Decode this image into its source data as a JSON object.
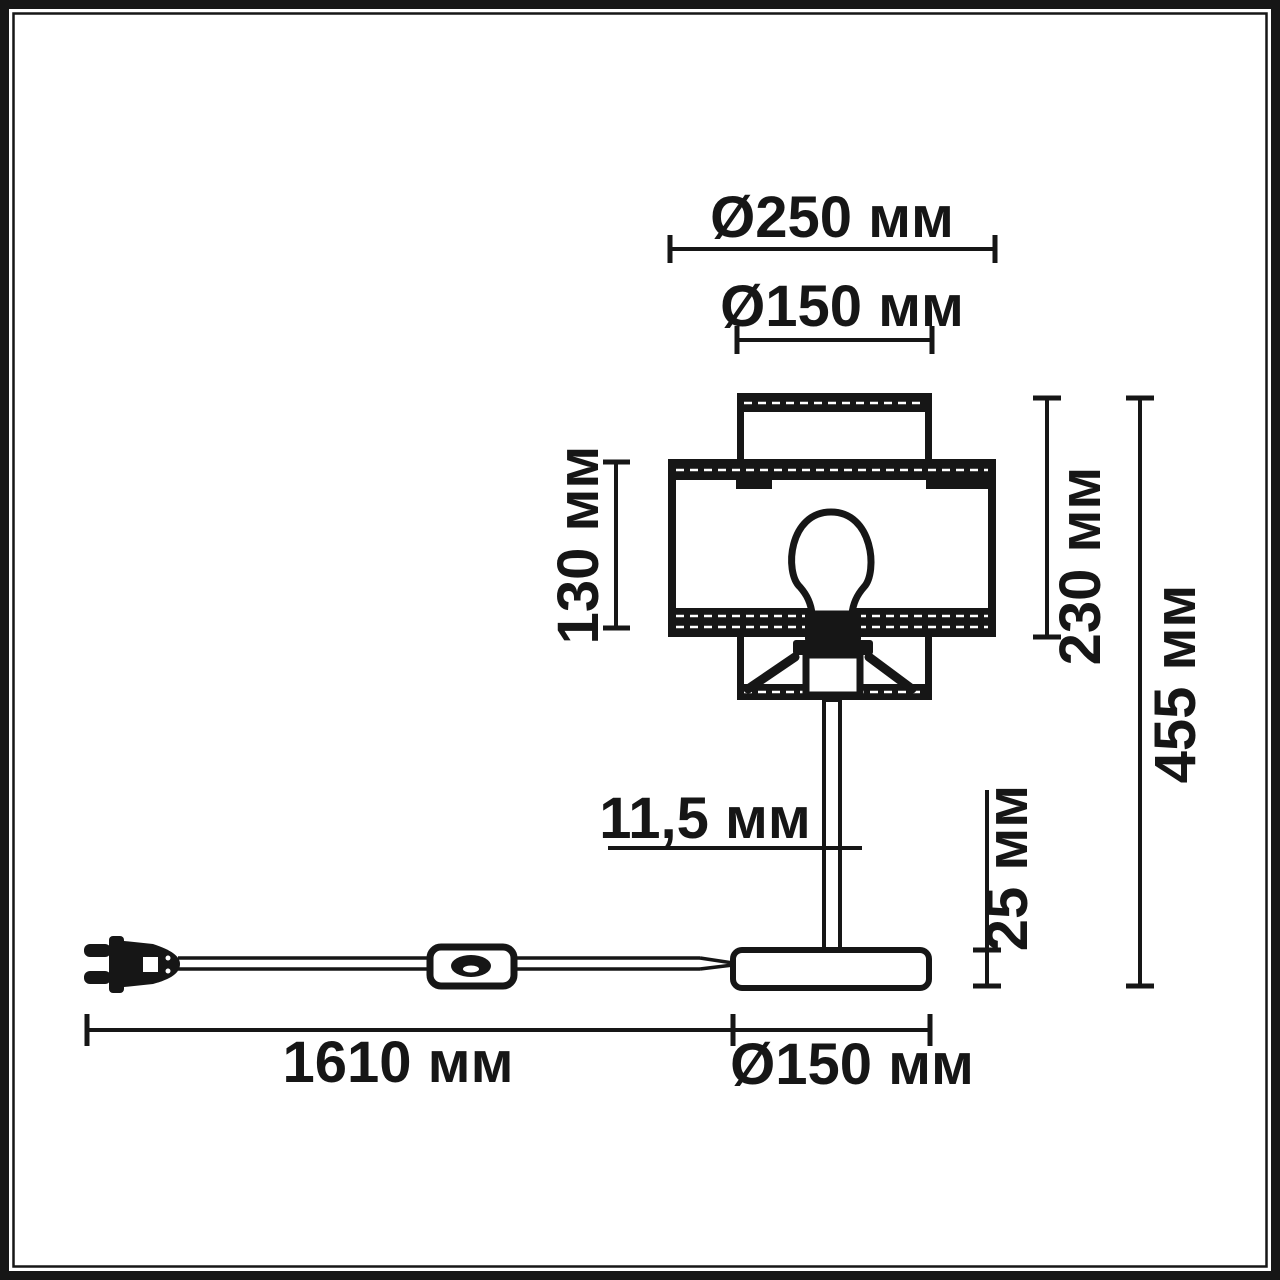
{
  "meta": {
    "type": "technical dimension drawing",
    "subject": "table lamp with cylindrical shade, bulb, stem, round base, power cord with inline switch and plug",
    "unit": "мм",
    "ink_color": "#161616",
    "paper_color": "#ffffff"
  },
  "dimensions": {
    "shade_outer_diameter": {
      "label": "Ø250 мм",
      "value": 250,
      "unit": "мм"
    },
    "shade_top_diameter": {
      "label": "Ø150 мм",
      "value": 150,
      "unit": "мм"
    },
    "shade_height": {
      "label": "130 мм",
      "value": 130,
      "unit": "мм"
    },
    "shade_assembly_height": {
      "label": "230 мм",
      "value": 230,
      "unit": "мм"
    },
    "total_height": {
      "label": "455 мм",
      "value": 455,
      "unit": "мм"
    },
    "stem_diameter": {
      "label": "11,5 мм",
      "value": 11.5,
      "unit": "мм"
    },
    "base_height": {
      "label": "25 мм",
      "value": 25,
      "unit": "мм"
    },
    "cable_length": {
      "label": "1610 мм",
      "value": 1610,
      "unit": "мм"
    },
    "base_diameter": {
      "label": "Ø150 мм",
      "value": 150,
      "unit": "мм"
    }
  }
}
